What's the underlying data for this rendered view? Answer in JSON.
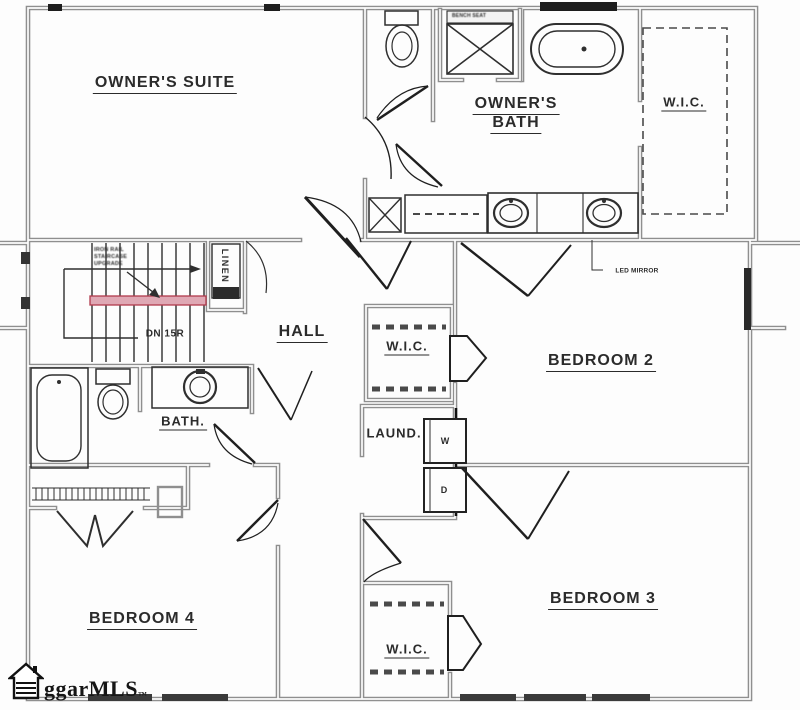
{
  "rooms": {
    "owners_suite": {
      "label": "OWNER'S SUITE"
    },
    "owners_bath": {
      "line1": "OWNER'S",
      "line2": "BATH"
    },
    "wic_owners": {
      "label": "W.I.C."
    },
    "hall": {
      "label": "HALL"
    },
    "bedroom_2": {
      "label": "BEDROOM 2"
    },
    "wic_bedroom_2": {
      "label": "W.I.C."
    },
    "laundry": {
      "label": "LAUND."
    },
    "hall_bath": {
      "label": "BATH."
    },
    "bedroom_4": {
      "label": "BEDROOM 4"
    },
    "bedroom_3": {
      "label": "BEDROOM 3"
    },
    "wic_bedroom_3": {
      "label": "W.I.C."
    },
    "linen_closet": {
      "label": "LINEN"
    }
  },
  "annotations": {
    "stair_direction": "DN 15R",
    "led_mirror": "LED MIRROR",
    "bench_seat": "BENCH SEAT",
    "washer": "W",
    "dryer": "D",
    "stair_note": [
      "IRON RAIL",
      "STAIRCASE",
      "UPGRADE"
    ]
  },
  "watermark": {
    "text": "ggarMLS",
    "trademark": "™"
  },
  "colors": {
    "background": "#fdfdfd",
    "wall_gray": "#8f8f8f",
    "line_dark": "#2f2f2f",
    "stair_highlight_fill": "#dfa8b4",
    "stair_highlight_edge": "#b13a4c",
    "window_black": "#1d1d1d"
  }
}
